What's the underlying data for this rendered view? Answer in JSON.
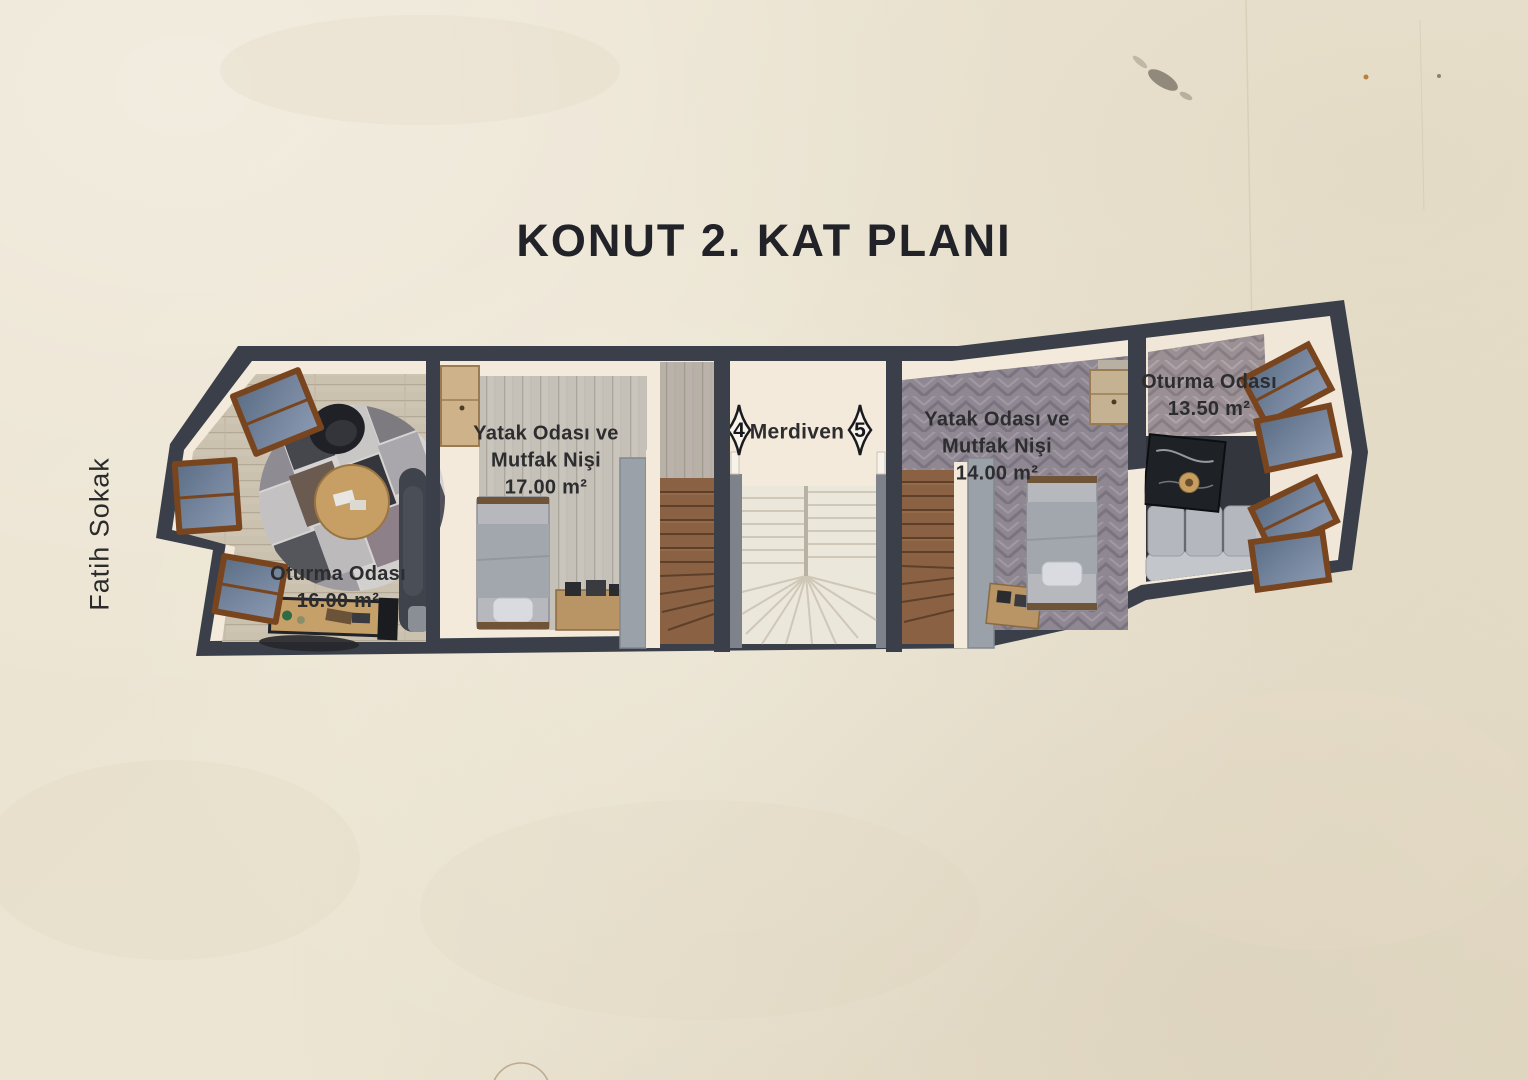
{
  "title": "KONUT 2. KAT PLANI",
  "street": {
    "label": "Fatih Sokak"
  },
  "plan": {
    "rooms": [
      {
        "name_lines": [
          "Oturma Odası"
        ],
        "area": "16.00 m²"
      },
      {
        "name_lines": [
          "Yatak Odası ve",
          "Mutfak Nişi"
        ],
        "area": "17.00 m²"
      },
      {
        "name_lines": [
          "Yatak Odası ve",
          "Mutfak Nişi"
        ],
        "area": "14.00 m²"
      },
      {
        "name_lines": [
          "Oturma Odası"
        ],
        "area": "13.50 m²"
      }
    ],
    "stairs": {
      "label": "Merdiven",
      "marker_left": "4",
      "marker_right": "5"
    }
  },
  "colors": {
    "wall": "#3a3f4a",
    "paper": "#ece4d2",
    "interior_wall": "#f3eadb",
    "label_text": "#2d2d2f"
  }
}
